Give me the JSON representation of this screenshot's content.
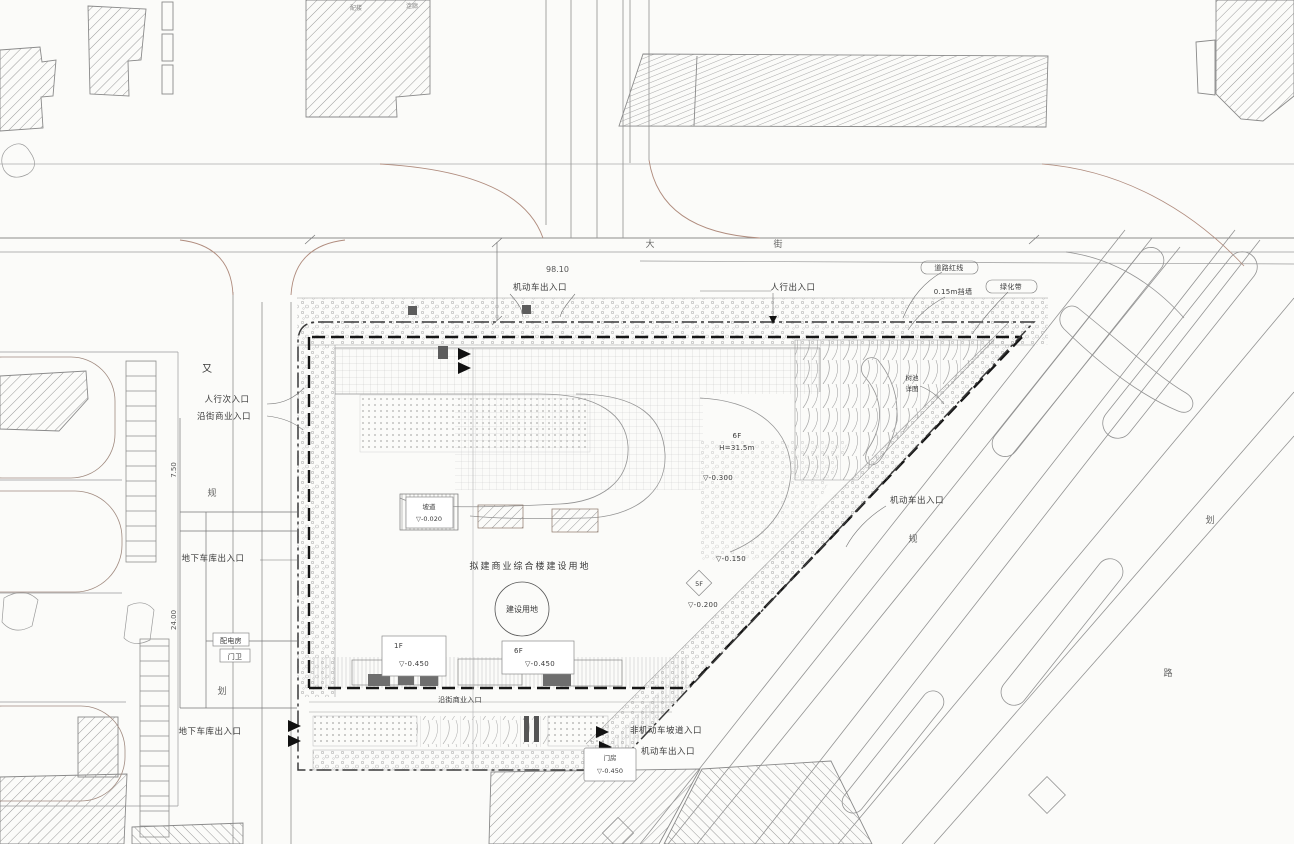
{
  "title": "建设项目总平面图",
  "colors": {
    "paper": "#fbfbf9",
    "context_line": "#9b9b9b",
    "warm_curb": "#b08c7e",
    "boundary_line": "#3a3a3a",
    "wall_line": "#161616",
    "text": "#3a3a3a"
  },
  "entrances": {
    "top_vehicle": "机动车出入口",
    "top_pedestrian": "人行出入口",
    "left_mark": "又",
    "left_pedestrian_1": "人行次入口",
    "left_pedestrian_2": "沿街商业入口",
    "left_garage": "地下车库出入口",
    "bottom_left_garage": "地下车库出入口",
    "bottom_shops": "沿街商业入口",
    "bottom_nonmotor": "非机动车坡道入口",
    "bottom_vehicle": "机动车出入口",
    "right_vehicle": "机动车出入口"
  },
  "boundary_notes": {
    "red_line": "道路红线",
    "wall": "0.15m挡墙",
    "green": "绿化带",
    "tree_pool_1": "树池",
    "tree_pool_2": "详图"
  },
  "site_center": {
    "title": "拟建商业综合楼建设用地",
    "circle": "建设用地"
  },
  "elevation_boxes": {
    "ramp": {
      "l1": "坡道",
      "l2": "▽-0.020"
    },
    "b1": {
      "floor": "1F",
      "elev": "▽-0.450"
    },
    "b2": {
      "floor": "6F",
      "elev": "▽-0.450"
    },
    "gate": {
      "l1": "门房",
      "l2": "▽-0.450"
    }
  },
  "spot_elevations": {
    "a": "▽-0.300",
    "b": "▽-0.150",
    "c": "▽-0.200",
    "d1": "6F",
    "d2": "H=31.5m",
    "diamond": "5F"
  },
  "dimensions": {
    "top_width": "98.10",
    "left_upper": "7.50",
    "left_lower": "24.00"
  },
  "road_chars": {
    "west": [
      {
        "t": "规"
      },
      {
        "t": "划"
      }
    ],
    "north": [
      {
        "t": "大"
      },
      {
        "t": "街"
      }
    ],
    "southeast": [
      {
        "t": "规"
      },
      {
        "t": "划"
      },
      {
        "t": "路"
      }
    ]
  },
  "misc": {
    "annex": "配楼",
    "corridor": "连廊",
    "utility": "配电房",
    "guard": "门卫"
  }
}
